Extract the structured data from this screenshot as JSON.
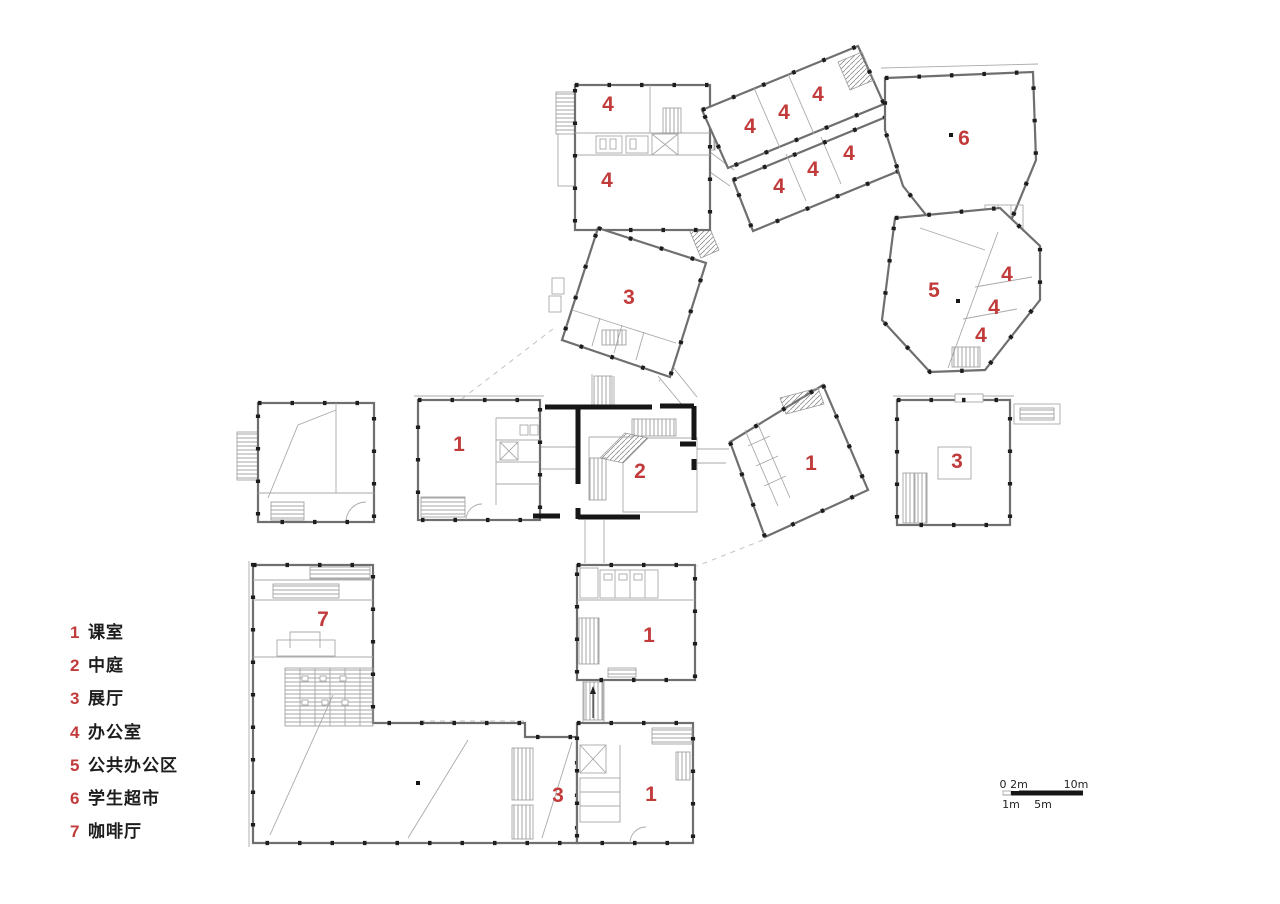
{
  "title": "first-floor-plan",
  "colors": {
    "background": "#ffffff",
    "wall_gray": "#6f6f6f",
    "thin_gray": "#a9a9a9",
    "black_wall": "#161616",
    "label_red": "#c23b3b"
  },
  "legend": {
    "items": [
      {
        "num": "1",
        "label": "课室"
      },
      {
        "num": "2",
        "label": "中庭"
      },
      {
        "num": "3",
        "label": "展厅"
      },
      {
        "num": "4",
        "label": "办公室"
      },
      {
        "num": "5",
        "label": "公共办公区"
      },
      {
        "num": "6",
        "label": "学生超市"
      },
      {
        "num": "7",
        "label": "咖啡厅"
      }
    ]
  },
  "plan": {
    "rooms": [
      {
        "n": "4",
        "x": 608,
        "y": 111
      },
      {
        "n": "4",
        "x": 607,
        "y": 187
      },
      {
        "n": "4",
        "x": 750,
        "y": 133
      },
      {
        "n": "4",
        "x": 784,
        "y": 119
      },
      {
        "n": "4",
        "x": 818,
        "y": 101
      },
      {
        "n": "4",
        "x": 779,
        "y": 193
      },
      {
        "n": "4",
        "x": 813,
        "y": 176
      },
      {
        "n": "4",
        "x": 849,
        "y": 160
      },
      {
        "n": "6",
        "x": 964,
        "y": 145
      },
      {
        "n": "5",
        "x": 934,
        "y": 297
      },
      {
        "n": "4",
        "x": 1007,
        "y": 281
      },
      {
        "n": "4",
        "x": 994,
        "y": 314
      },
      {
        "n": "4",
        "x": 981,
        "y": 342
      },
      {
        "n": "3",
        "x": 629,
        "y": 304
      },
      {
        "n": "1",
        "x": 459,
        "y": 451
      },
      {
        "n": "2",
        "x": 640,
        "y": 478
      },
      {
        "n": "1",
        "x": 811,
        "y": 470
      },
      {
        "n": "3",
        "x": 957,
        "y": 468
      },
      {
        "n": "7",
        "x": 323,
        "y": 626
      },
      {
        "n": "1",
        "x": 649,
        "y": 642
      },
      {
        "n": "3",
        "x": 558,
        "y": 802
      },
      {
        "n": "1",
        "x": 651,
        "y": 801
      }
    ]
  },
  "scale_bar": {
    "top_labels": [
      {
        "text": "0",
        "x": 1003
      },
      {
        "text": "2m",
        "x": 1019
      },
      {
        "text": "10m",
        "x": 1076
      }
    ],
    "bottom_labels": [
      {
        "text": "1m",
        "x": 1011
      },
      {
        "text": "5m",
        "x": 1043
      }
    ]
  }
}
